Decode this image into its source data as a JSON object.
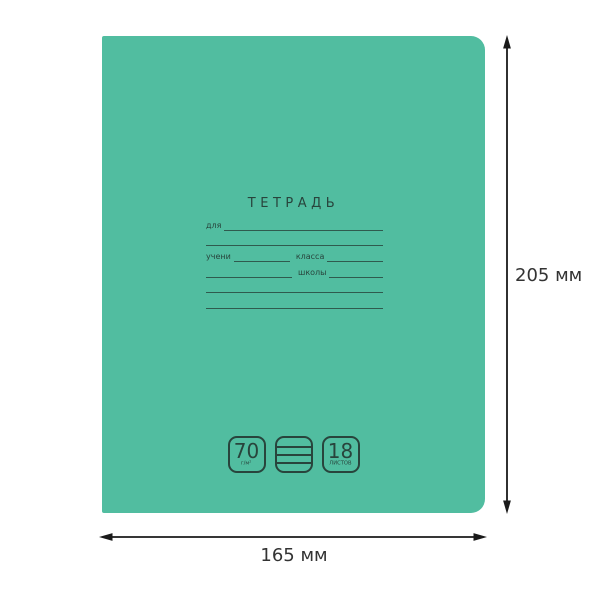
{
  "cover": {
    "title": "ТЕТРАДЬ",
    "form": {
      "for_label": "для",
      "student_label": "учени",
      "class_label": "класса",
      "school_label": "школы"
    },
    "badges": [
      {
        "name": "paper-density-badge",
        "value": "70",
        "unit": "г/м²"
      },
      {
        "name": "ruling-badge",
        "icon": "ruled-lines-icon"
      },
      {
        "name": "sheet-count-badge",
        "value": "18",
        "unit": "ЛИСТОВ"
      }
    ]
  },
  "dimensions": {
    "height": "205 мм",
    "width": "165 мм"
  },
  "colors": {
    "cover_green": "#51bda0",
    "cover_ink": "#28443c",
    "annotation_black": "#1a1a1a",
    "annotation_text": "#333333",
    "background": "#ffffff"
  }
}
